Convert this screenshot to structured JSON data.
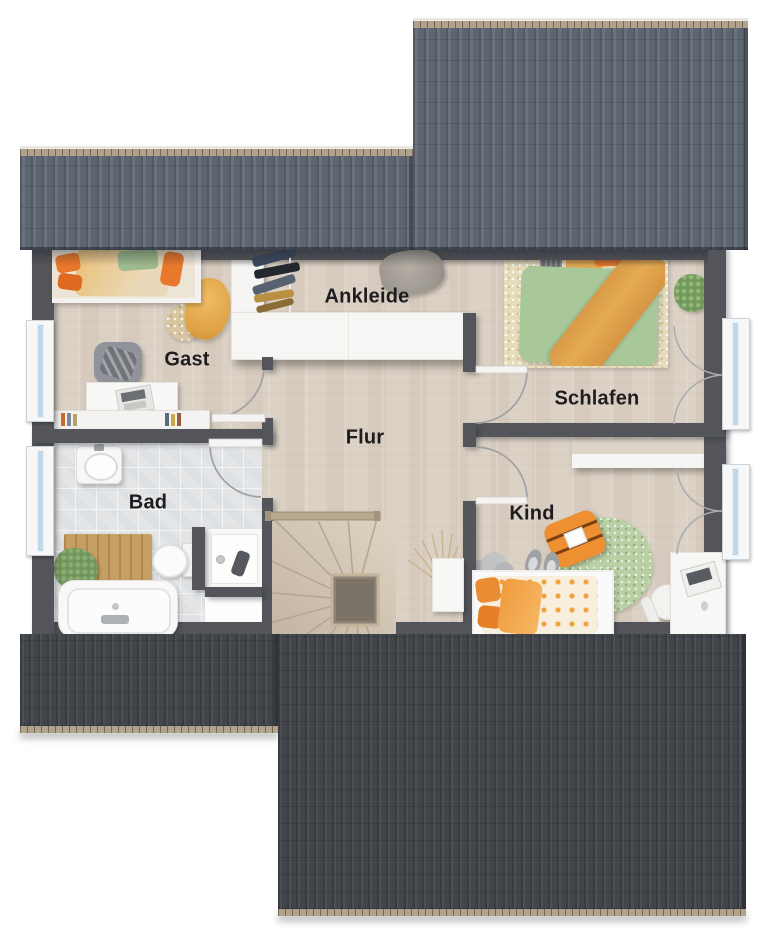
{
  "plan": {
    "type": "floor-plan",
    "rooms": [
      {
        "id": "gast",
        "label": "Gast"
      },
      {
        "id": "ankleide",
        "label": "Ankleide"
      },
      {
        "id": "schlafen",
        "label": "Schlafen"
      },
      {
        "id": "flur",
        "label": "Flur"
      },
      {
        "id": "bad",
        "label": "Bad"
      },
      {
        "id": "kind",
        "label": "Kind"
      }
    ]
  },
  "palette": {
    "roof-top": "#5d6571",
    "roof-top-stripe": "#6a7280",
    "roof-top-dark": "#525a64",
    "roof-bottom": "#42464b",
    "roof-bottom-stripe": "#4c5056",
    "roof-bottom-dark": "#393d42",
    "roof-ridge": "#b1a28b",
    "wall": "#53555a",
    "floor-wood": "#dbd1c5",
    "floor-tile": "#e3e5e7",
    "furniture-white": "#f8f7f6",
    "window-glass": "#bfd7e6",
    "accent-orange": "#e8782b",
    "accent-mustard": "#e5aa52",
    "accent-green": "#a9c89a",
    "rug-green": "#b9d0a4",
    "rug-beige": "#e6dcbc",
    "stair-wood": "#d6c9b7",
    "stair-rail": "#b7a88f",
    "label-color": "#1d1d1f"
  }
}
